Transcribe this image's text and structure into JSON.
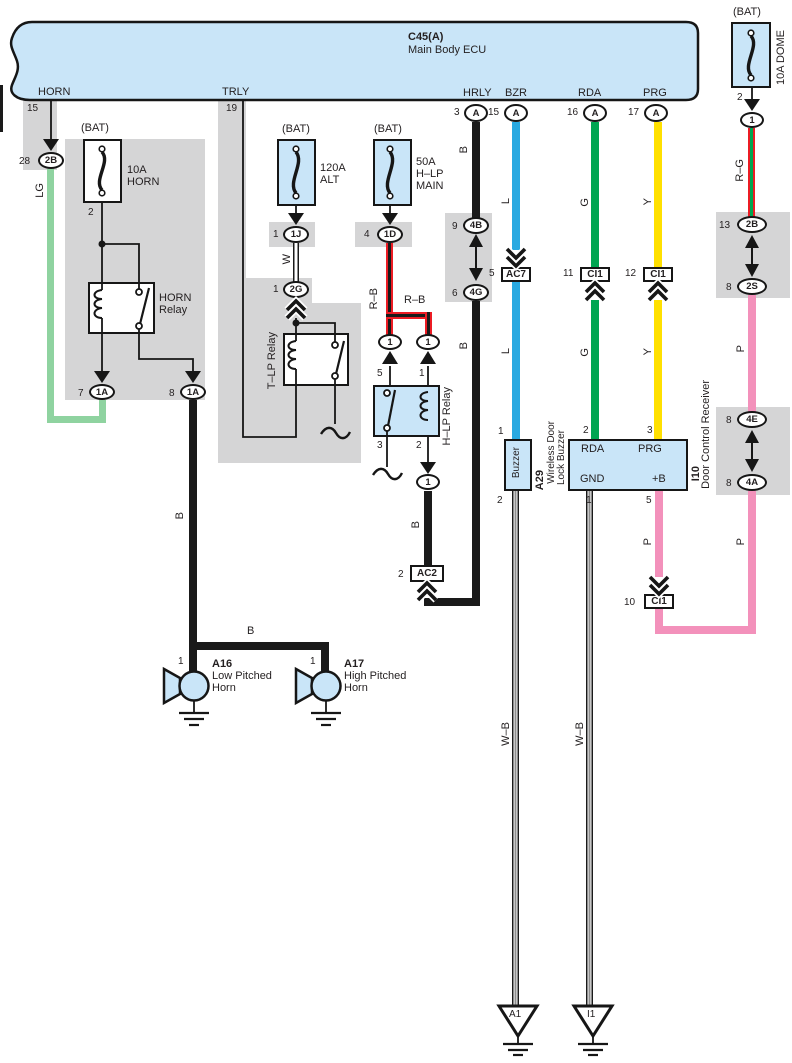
{
  "ecu": {
    "code": "C45(A)",
    "name": "Main Body ECU",
    "conn_a": "A",
    "horn": "HORN",
    "horn_num": "15",
    "trly": "TRLY",
    "trly_num": "19",
    "hrly": "HRLY",
    "hrly_num": "3",
    "bzr": "BZR",
    "bzr_num": "15",
    "rda": "RDA",
    "rda_num": "16",
    "prg": "PRG",
    "prg_num": "17"
  },
  "horn": {
    "num28": "28",
    "c2b": "2B",
    "lg": "LG",
    "bat": "(BAT)",
    "fuse_a": "10A",
    "fuse_n": "HORN",
    "pin2": "2",
    "relay1": "HORN",
    "relay2": "Relay",
    "num7": "7",
    "num8": "8",
    "c1a": "1A",
    "wb": "B",
    "bhoriz": "B",
    "pin1": "1",
    "a16": "A16",
    "a16n1": "Low Pitched",
    "a16n2": "Horn",
    "a17": "A17",
    "a17n1": "High Pitched",
    "a17n2": "Horn"
  },
  "tlp": {
    "bat": "(BAT)",
    "fuse_a": "120A",
    "fuse_n": "ALT",
    "n1": "1",
    "c1j": "1J",
    "w": "W",
    "n2": "1",
    "c2g": "2G",
    "relay": "T–LP Relay"
  },
  "hlp": {
    "bat": "(BAT)",
    "fuse_a": "50A",
    "fuse_n1": "H–LP",
    "fuse_n2": "MAIN",
    "n4": "4",
    "c1d": "1D",
    "rb1": "R–B",
    "rb2": "R–B",
    "c1": "1",
    "p5": "5",
    "p1": "1",
    "p3": "3",
    "p2": "2",
    "relay": "H–LP Relay",
    "b": "B",
    "ac2n": "2",
    "ac2": "AC2"
  },
  "hrly": {
    "b1": "B",
    "b2": "B",
    "n9": "9",
    "c4b": "4B",
    "n6": "6",
    "c4g": "4G"
  },
  "bzr": {
    "l1": "L",
    "l2": "L",
    "n5": "5",
    "ac7": "AC7",
    "p1": "1",
    "p2": "2",
    "name": "Buzzer",
    "code": "A29",
    "n1": "Wireless Door",
    "n2": "Lock Buzzer",
    "wb": "W–B",
    "gnd": "A1"
  },
  "recv": {
    "g1": "G",
    "g2": "G",
    "n11": "11",
    "ci1a": "CI1",
    "y1": "Y",
    "y2": "Y",
    "n12": "12",
    "ci1b": "CI1",
    "p2": "2",
    "p3": "3",
    "rda": "RDA",
    "prg": "PRG",
    "gnd": "GND",
    "pb": "+B",
    "p1": "1",
    "p5": "5",
    "code": "I10",
    "name": "Door Control Receiver",
    "wb": "W–B",
    "p": "P",
    "n10": "10",
    "ci1c": "CI1",
    "gnd2": "I1"
  },
  "dome": {
    "bat": "(BAT)",
    "fuse": "10A DOME",
    "pin2": "2",
    "c1": "1",
    "rg": "R–G",
    "n13": "13",
    "c2b": "2B",
    "n8a": "8",
    "c2s": "2S",
    "pmid": "P",
    "plow": "P",
    "n8b": "8",
    "c4e": "4E",
    "n8c": "8",
    "c4a": "4A"
  },
  "colors": {
    "ecu_fill": "#c9e5f8",
    "gray": "#d5d5d6",
    "lg": "#8fd3a0",
    "blue": "#29a9e1",
    "green": "#00a551",
    "yellow": "#ffe000",
    "pink": "#f391bb",
    "red": "#ec1c24",
    "line": "#1a1a1a"
  }
}
